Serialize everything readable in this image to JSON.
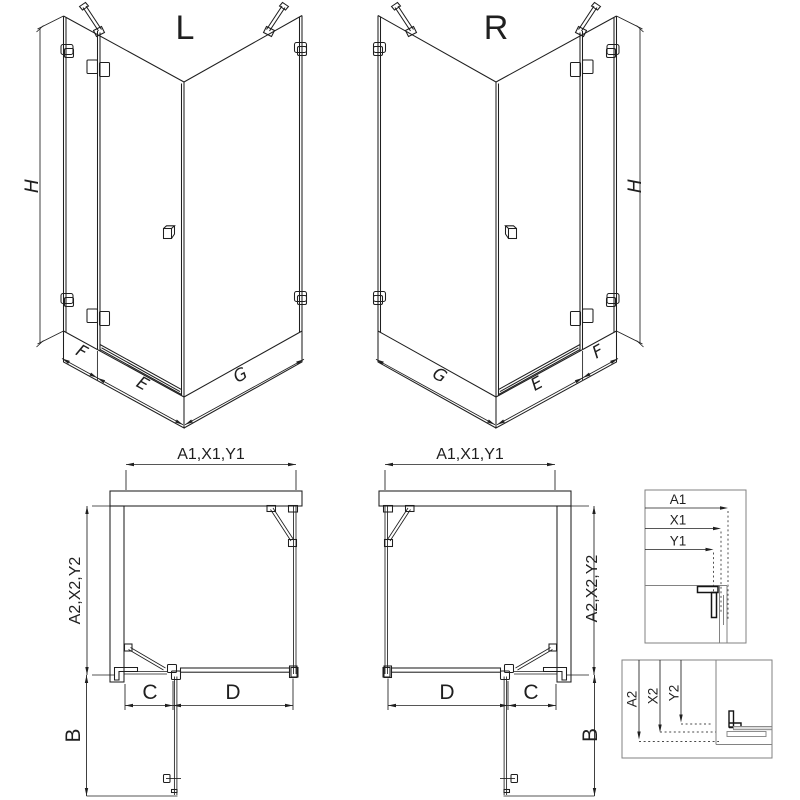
{
  "colors": {
    "background": "#ffffff",
    "line": "#1f1f1f",
    "gray_line": "#828282",
    "dark_fill": "#141414"
  },
  "iso_left": {
    "title": "L",
    "height_label": "H",
    "panel_label": "F",
    "door_label": "E",
    "side_label": "G"
  },
  "iso_right": {
    "title": "R",
    "height_label": "H",
    "panel_label": "F",
    "door_label": "E",
    "side_label": "G"
  },
  "plan_left": {
    "width_label": "A1,X1,Y1",
    "depth_label": "A2,X2,Y2",
    "panel_label": "C",
    "door_label": "D",
    "swing_label": "B"
  },
  "plan_right": {
    "width_label": "A1,X1,Y1",
    "depth_label": "A2,X2,Y2",
    "panel_label": "C",
    "door_label": "D",
    "swing_label": "B"
  },
  "detail_width": {
    "labels": [
      "A1",
      "X1",
      "Y1"
    ]
  },
  "detail_depth": {
    "labels": [
      "A2",
      "X2",
      "Y2"
    ]
  }
}
